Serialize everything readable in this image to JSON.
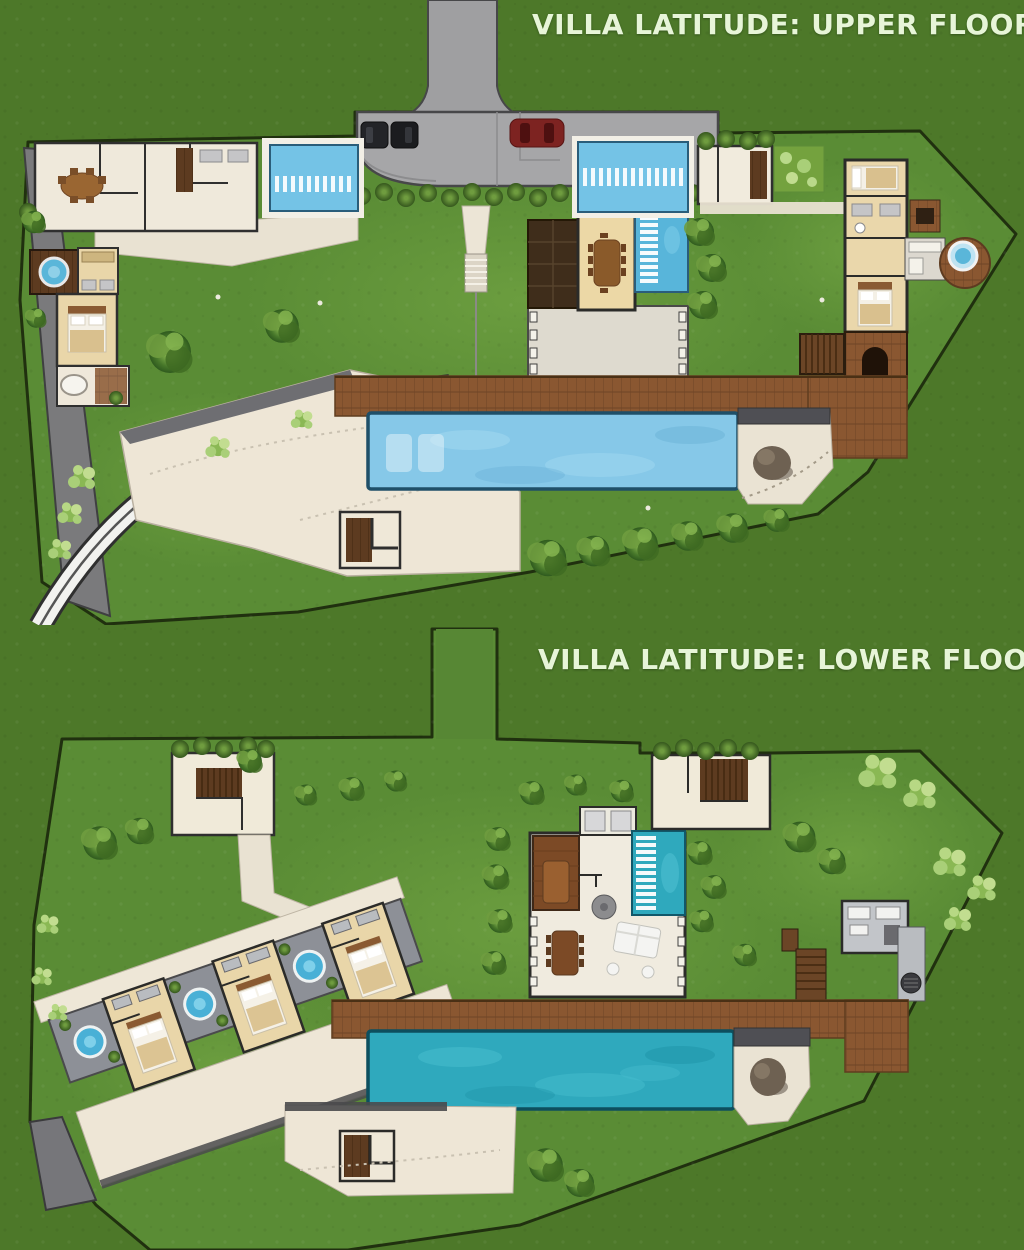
{
  "page": {
    "width": 1024,
    "height": 1250,
    "background_color": "#4d7829"
  },
  "plans": [
    {
      "id": "upper-floor",
      "title": "VILLA LATITUDE: UPPER FLOOR",
      "features": [
        "driveway",
        "parking-court",
        "car-dark-1",
        "car-dark-2",
        "car-red",
        "hedge-row",
        "lap-pool-left",
        "lap-pool-right",
        "koi-pond-stepping-stones",
        "dining-pavilion",
        "dining-table",
        "media-roof",
        "colonnade-terrace",
        "kitchen-dining-wing",
        "round-dining-table",
        "interior-stairs",
        "master-suite-left",
        "round-plunge-tub-left",
        "outdoor-bathtub",
        "guest-stair-room",
        "planter-bed",
        "master-suite-right",
        "outdoor-jacuzzi",
        "bbq-deck",
        "fireplace-deck",
        "side-stairs",
        "timber-deck",
        "infinity-pool",
        "submerged-loungers",
        "stone-patio",
        "boulder",
        "garden-path-steps",
        "curved-access-road",
        "retaining-terrace",
        "terrace-stairs",
        "lawn",
        "shrub-row",
        "trees",
        "side-road"
      ]
    },
    {
      "id": "lower-floor",
      "title": "VILLA LATITUDE: LOWER FLOOR",
      "features": [
        "entry-corridor",
        "stair-enclosure",
        "garden-path",
        "guest-suite-1",
        "guest-suite-2",
        "guest-suite-3",
        "plunge-tub-courtyards",
        "suite-walkway",
        "suite-terrace",
        "living-pavilion",
        "bathroom-fixtures",
        "media-room",
        "water-stair-feature",
        "round-table",
        "dining-table",
        "lounge-sofas",
        "colonnade-columns",
        "upper-stair-room",
        "gym-room",
        "bbq-grill",
        "service-stairs",
        "timber-deck",
        "infinity-pool",
        "stone-patio",
        "boulder",
        "lower-terrace",
        "terrace-stairs",
        "path-wedge",
        "trees",
        "lawn"
      ]
    }
  ],
  "palette": {
    "grass_inside": "#5a8c35",
    "grass_outside": "#4d7829",
    "boundary_line": "#20300f",
    "driveway_gray": "#a6a6a8",
    "car_dark": "#1d1e22",
    "car_red": "#7d2321",
    "pool_light_blue": "#86c8e8",
    "pool_teal": "#2fa9bd",
    "lane_marker_white": "#ffffff",
    "deck_wood_brown": "#8a5731",
    "building_cream": "#f0ebdf",
    "bedroom_beige": "#e9d6a9",
    "roof_dark_brown": "#3f2d1b",
    "courtyard_gray": "#8d9097",
    "stone_patio": "#eae3d3",
    "boulder_gray": "#6e6152",
    "hedge_green": "#47772a",
    "title_text": "#e7f5d8"
  }
}
